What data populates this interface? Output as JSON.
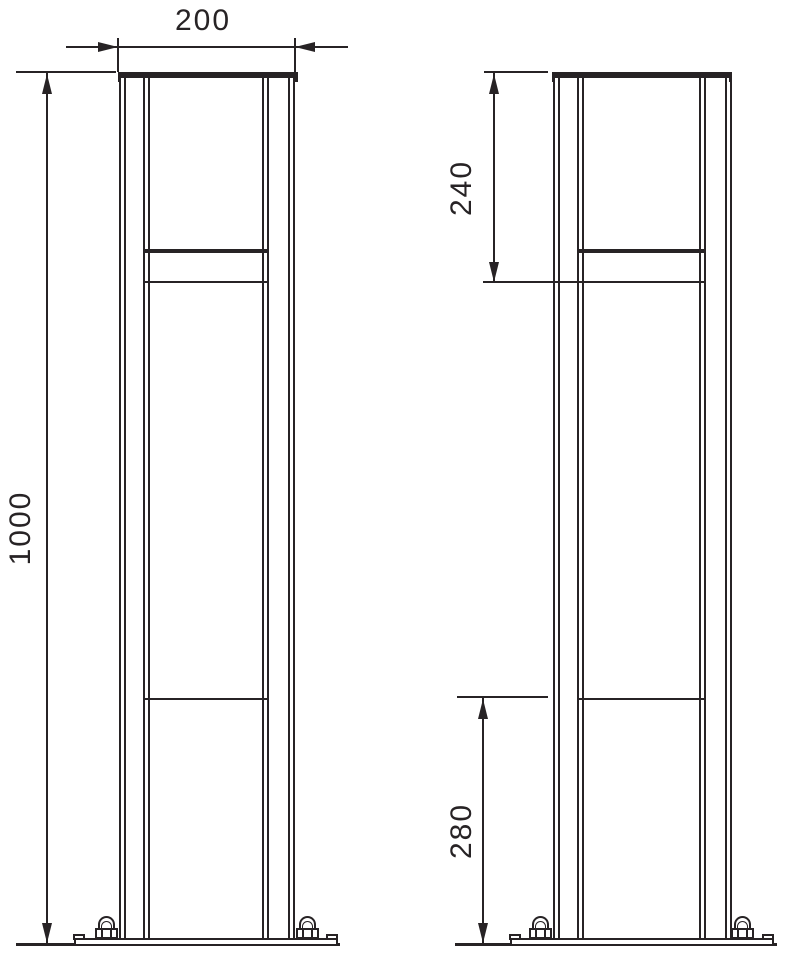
{
  "diagram": {
    "dimensions": {
      "overall_width": "200",
      "overall_height": "1000",
      "upper_section": "240",
      "lower_section": "280"
    },
    "colors": {
      "line": "#272325",
      "background": "#ffffff"
    }
  }
}
